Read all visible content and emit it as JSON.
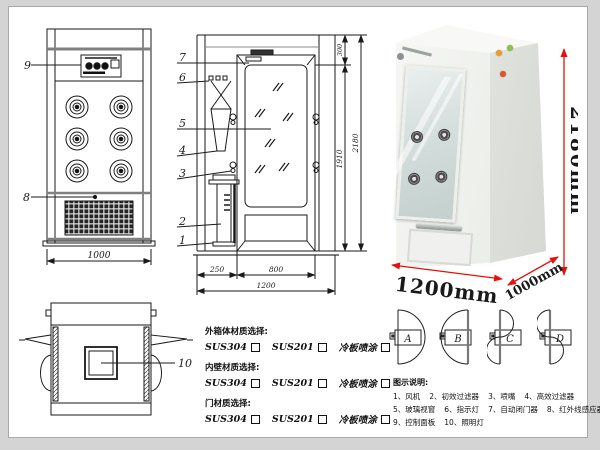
{
  "front_view": {
    "label_9": "9",
    "label_8": "8",
    "dim_width": "1000"
  },
  "section_view": {
    "labels": {
      "l7": "7",
      "l6": "6",
      "l5": "5",
      "l4": "4",
      "l3": "3",
      "l2": "2",
      "l1": "1"
    },
    "dim_top": "300",
    "dim_door_height": "1910",
    "dim_total_height": "2180",
    "dim_left": "250",
    "dim_door_width": "800",
    "dim_total_width": "1200"
  },
  "top_view": {
    "label_10": "10"
  },
  "photo": {
    "dim_height": "2180mm",
    "dim_width": "1200mm",
    "dim_depth": "1000mm"
  },
  "materials": {
    "sections": [
      {
        "title": "外箱体材质选择:",
        "options": [
          "SUS304",
          "SUS201",
          "冷板喷涂"
        ]
      },
      {
        "title": "内壁材质选择:",
        "options": [
          "SUS304",
          "SUS201",
          "冷板喷涂"
        ]
      },
      {
        "title": "门材质选择:",
        "options": [
          "SUS304",
          "SUS201",
          "冷板喷涂"
        ]
      }
    ]
  },
  "door_configs": {
    "a": "A",
    "b": "B",
    "c": "C",
    "d": "D"
  },
  "legend": {
    "title": "图示说明:",
    "items": [
      "1、风机",
      "2、初效过滤器",
      "3、喷嘴",
      "4、高效过滤器",
      "5、玻璃视窗",
      "6、指示灯",
      "7、自动闭门器",
      "8、红外线感应器",
      "9、控制面板",
      "10、照明灯"
    ]
  },
  "colors": {
    "dimension_red": "#e8100c",
    "line_color": "#1a1a1a",
    "button_green": "#8bc63f",
    "button_orange": "#f59a23",
    "button_red": "#e2531f"
  }
}
